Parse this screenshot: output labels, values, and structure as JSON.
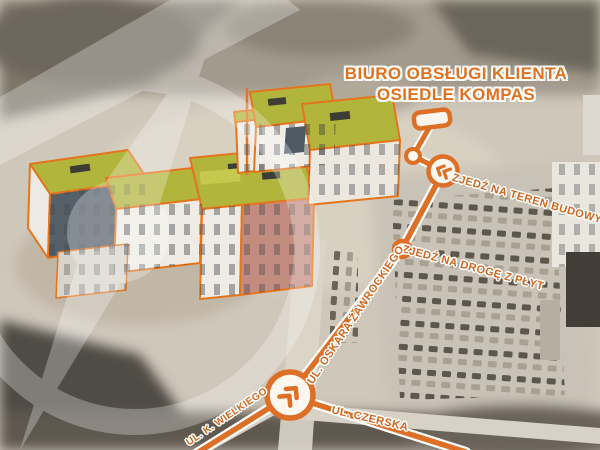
{
  "map": {
    "title": {
      "line1": "BIURO OBSŁUGI KLIENTA",
      "line2": "OSIEDLE KOMPAS"
    },
    "directions": [
      {
        "id": "zjedz-na-teren-budowy",
        "label": "ZJEDŹ NA TEREN BUDOWY"
      },
      {
        "id": "zjedz-na-droge-z-plyt",
        "label": "ZJEDŹ NA DROGĘ Z PŁYT"
      }
    ],
    "streets": [
      {
        "id": "ul-oskara-zawrockiego",
        "label": "UL. OSKARA ŻAWROCKIEGO"
      },
      {
        "id": "ul-k-wielkiego",
        "label": "UL. K. WIELKIEGO"
      },
      {
        "id": "ul-czerska",
        "label": "UL. CZERSKA"
      }
    ],
    "markers": [
      {
        "id": "office-sign-marker",
        "type": "rounded-sign",
        "meaning": "customer service office location"
      },
      {
        "id": "turn-marker-top",
        "type": "chevron-circle",
        "direction": "left"
      },
      {
        "id": "waypoint-dot-top",
        "type": "dot"
      },
      {
        "id": "waypoint-dot-mid",
        "type": "dot"
      },
      {
        "id": "junction-marker",
        "type": "chevron-circle",
        "direction": "up-right"
      }
    ],
    "watermark": "kompas-compass-logo",
    "colors": {
      "accent_orange": "#DD6F26",
      "label_orange": "#D2661E",
      "route_casing": "#FFFFFF",
      "roof_olive": "#B2B53B",
      "facade_pink": "#C28D80",
      "photo_sepia": "#CFC7BA"
    }
  }
}
